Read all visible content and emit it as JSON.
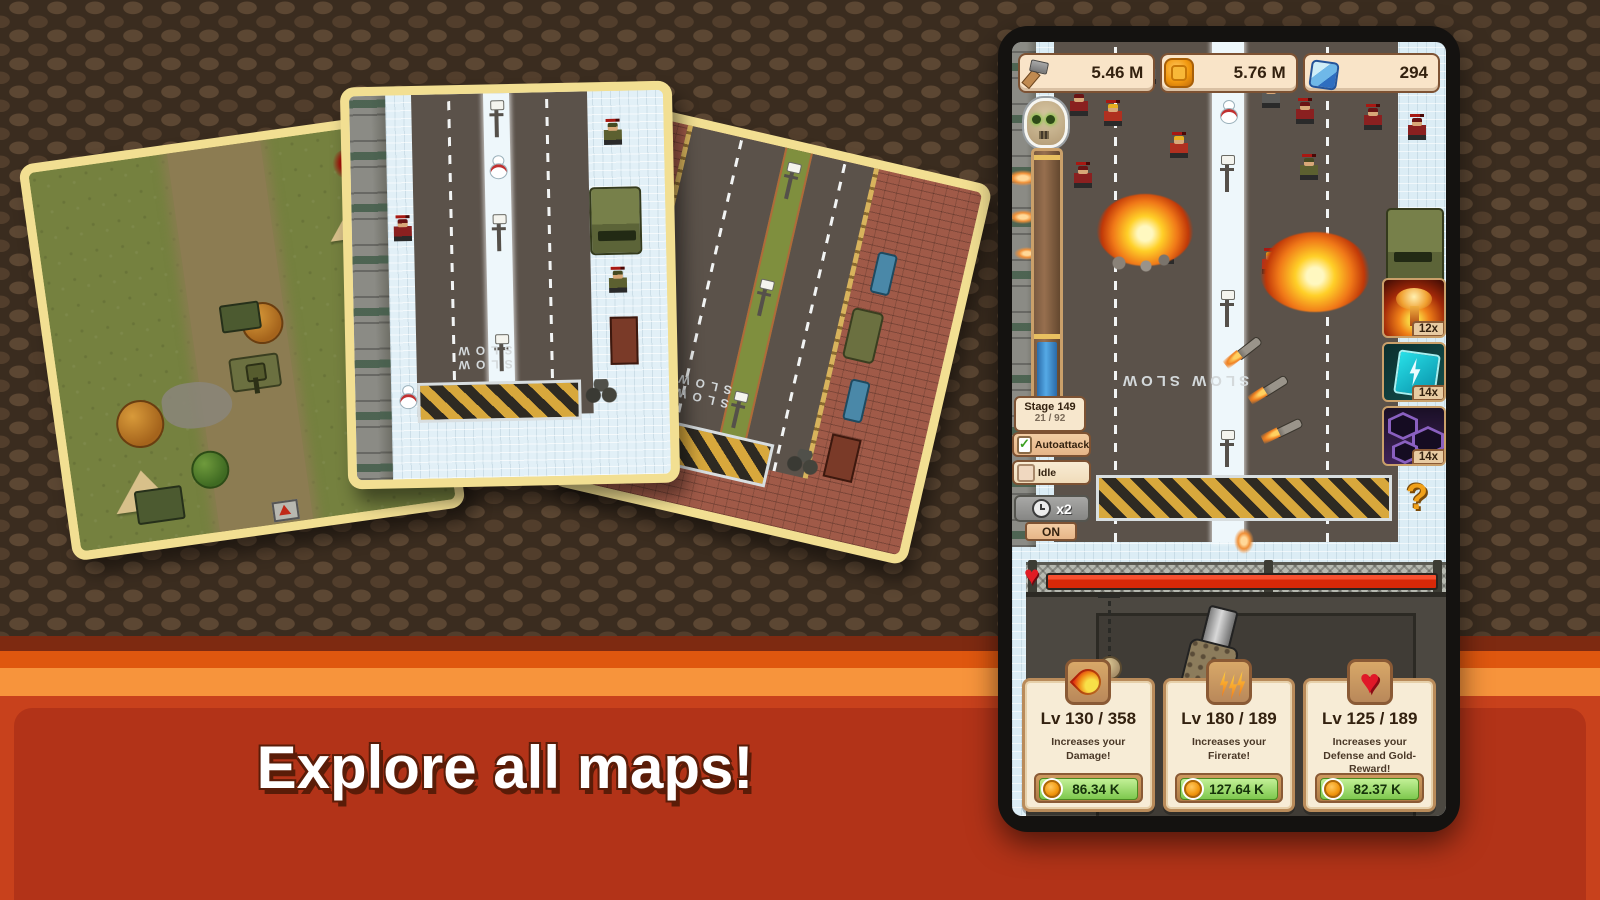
{
  "banner": {
    "headline": "Explore all maps!"
  },
  "maps": {
    "road_marking": "SLOW SLOW"
  },
  "phone": {
    "resources": [
      {
        "icon": "hammer-icon",
        "value": "5.46 M"
      },
      {
        "icon": "medal-icon",
        "value": "5.76 M"
      },
      {
        "icon": "diamond-icon",
        "value": "294"
      }
    ],
    "stage": {
      "title": "Stage 149",
      "progress": "21 / 92"
    },
    "autoattack_label": "Autoattack",
    "idle_label": "Idle",
    "speed": {
      "multiplier": "x2",
      "state": "ON"
    },
    "skills": [
      {
        "icon": "nuke-icon",
        "count": "12x"
      },
      {
        "icon": "lightning-card-icon",
        "count": "14x"
      },
      {
        "icon": "hex-card-icon",
        "count": "14x"
      }
    ],
    "help_label": "?",
    "road_marking": "SLOW SLOW",
    "upgrades": [
      {
        "icon": "damage-flame-icon",
        "level": "Lv 130 / 358",
        "description": "Increases your Damage!",
        "cost": "86.34 K"
      },
      {
        "icon": "firerate-icon",
        "level": "Lv 180 / 189",
        "description": "Increases your Firerate!",
        "cost": "127.64 K"
      },
      {
        "icon": "defense-heart-icon",
        "level": "Lv 125 / 189",
        "description": "Increases your Defense and Gold-Reward!",
        "cost": "82.37 K"
      }
    ]
  },
  "colors": {
    "accent_orange": "#f7943c",
    "banner_red": "#c8411c",
    "card_cream": "#f7ecd6",
    "price_green": "#93dd66"
  }
}
